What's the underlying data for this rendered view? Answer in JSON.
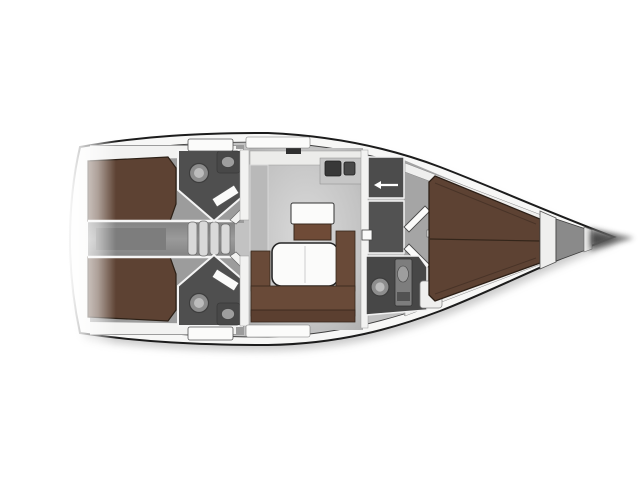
{
  "image": {
    "kind": "sailing-yacht-interior-deck-plan",
    "orientation": "bow-pointing-right",
    "background": "#ffffff"
  },
  "colors": {
    "background": "#ffffff",
    "hull_outline": "#1c1c1c",
    "deck_white": "#f7f7f6",
    "interior_gray": "#c2c2c2",
    "cabin_floor_gray": "#9c9c9c",
    "midband_gray": "#8f8f8f",
    "midband_dark": "#7d7d7d",
    "forward_floor_gray": "#a5a5a5",
    "bed_brown": "#5d4233",
    "bed_outline": "#2c2016",
    "sofa_brown": "#694a38",
    "sofa_back_brown": "#5b3f30",
    "sideboard_brown": "#6f4b37",
    "furniture_white": "#fbfbfa",
    "wall_white": "#f2f2f1",
    "head_dark_gray": "#4f4f4f",
    "head_dark_gray2": "#474747",
    "wardrobe_gray": "#4c4c4c",
    "locker_room_gray": "#525252",
    "fixture_gray": "#8d8d8d",
    "fixture_light": "#bcbcbc",
    "fixture_column_gray": "#7d7d7d",
    "sink_dark": "#383838",
    "sink_dark2": "#484848",
    "sink_basin_gray": "#9e9e9e",
    "counter_gray": "#c6c6c6",
    "galley_counter_gray": "#b9b9b9",
    "galley_top_white": "#ececea",
    "step_gray": "#d9d9d9",
    "locker_gray": "#8a8a8a",
    "band_white": "#e9e9e8",
    "shelf_white": "#efefee",
    "shadow_gray": "#9a9a9a",
    "bow_tip_dark": "#6f6f6f",
    "bow_tip_core": "#4a4a4a",
    "hatch_dark": "#2f2f2f"
  },
  "regions": {
    "aft_cabin_port": "aft double-berth cabin (top)",
    "aft_cabin_starboard": "aft double-berth cabin (bottom)",
    "aft_head_port": "aft bathroom with toilet and sink (top)",
    "aft_head_starboard": "aft bathroom with toilet and sink (bottom)",
    "companionway": "entry steps between aft cabins",
    "engine_compartment": "space between aft cabins",
    "salon": "main salon with table and U-sofa",
    "galley": "galley counter with double sink",
    "wardrobe": "dark locker beside salon",
    "forward_head": "forward bathroom with toilet, shower column and step",
    "forward_cabin": "bow V-berth cabin",
    "anchor_locker": "bow anchor locker",
    "bow_tip": "faded bow point",
    "stern": "faded stern edge"
  }
}
